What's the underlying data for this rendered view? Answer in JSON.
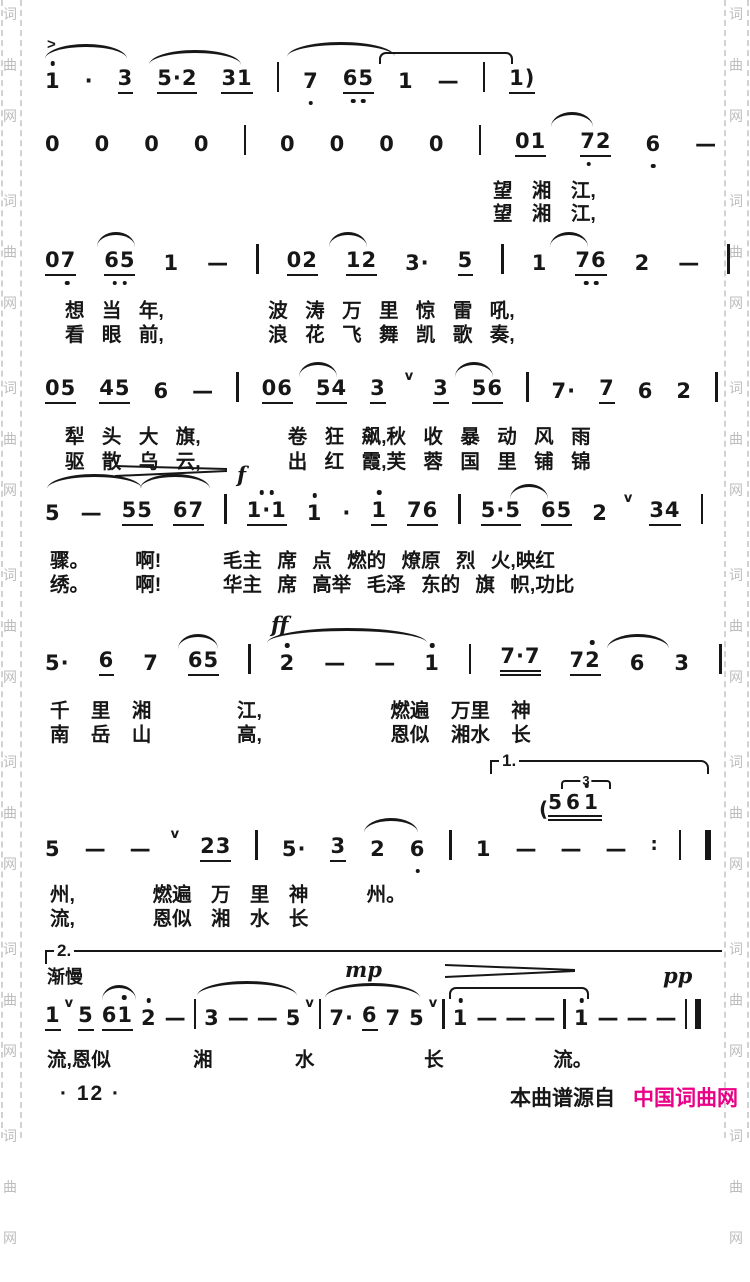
{
  "colors": {
    "ink": "#171717",
    "site_magenta": "#ea0087",
    "watermark_gray": "#bdbdbd"
  },
  "watermark": {
    "column": [
      "词",
      "曲",
      "网",
      "词",
      "曲",
      "网",
      "词",
      "曲",
      "网",
      "词",
      "曲",
      "网",
      "词",
      "曲",
      "网",
      "词",
      "曲",
      "网",
      "词",
      "曲",
      "网"
    ]
  },
  "page": {
    "number": "· 12 ·",
    "source_prefix": "本曲谱源自",
    "source_site": "中国词曲网"
  },
  "systems": [
    {
      "accent_mark": ">",
      "tokens": [
        {
          "t": "1",
          "c": "hd"
        },
        {
          "t": "·",
          "c": "aug"
        },
        {
          "t": "3",
          "c": "u1"
        },
        {
          "t": "5·2",
          "c": "u1"
        },
        {
          "t": "31",
          "c": "u1"
        },
        {
          "c": "bar"
        },
        {
          "t": "7",
          "c": "ld"
        },
        {
          "t": "65",
          "c": "u1 ld2"
        },
        {
          "t": "1"
        },
        {
          "t": "—",
          "c": "dash"
        },
        {
          "c": "bar"
        },
        {
          "t": "1)",
          "c": "u1"
        }
      ],
      "lyrics": []
    },
    {
      "tokens": [
        {
          "t": "0"
        },
        {
          "t": "0"
        },
        {
          "t": "0"
        },
        {
          "t": "0"
        },
        {
          "c": "bar"
        },
        {
          "t": "0"
        },
        {
          "t": "0"
        },
        {
          "t": "0"
        },
        {
          "t": "0"
        },
        {
          "c": "bar"
        },
        {
          "t": "01",
          "c": "u1"
        },
        {
          "t": "72",
          "c": "u1 ldl"
        },
        {
          "t": "6",
          "c": "ld"
        },
        {
          "t": "—",
          "c": "dash"
        },
        {
          "c": "bar"
        }
      ],
      "lyrics": [
        "望 湘 江,",
        "望 湘 江,"
      ]
    },
    {
      "tokens": [
        {
          "t": "07",
          "c": "u1 ldr"
        },
        {
          "t": "65",
          "c": "u1 ld2"
        },
        {
          "t": "1"
        },
        {
          "t": "—",
          "c": "dash"
        },
        {
          "c": "bar"
        },
        {
          "t": "02",
          "c": "u1"
        },
        {
          "t": "12",
          "c": "u1"
        },
        {
          "t": "3·"
        },
        {
          "t": "5",
          "c": "u1"
        },
        {
          "c": "bar"
        },
        {
          "t": "1"
        },
        {
          "t": "76",
          "c": "u1 ld2"
        },
        {
          "t": "2"
        },
        {
          "t": "—",
          "c": "dash"
        },
        {
          "c": "bar"
        }
      ],
      "lyrics": [
        "想 当 年,      波 涛 万 里 惊 雷 吼,",
        "看 眼 前,      浪 花 飞 舞 凯 歌 奏,"
      ]
    },
    {
      "tokens": [
        {
          "t": "05",
          "c": "u1"
        },
        {
          "t": "45",
          "c": "u1"
        },
        {
          "t": "6"
        },
        {
          "t": "—",
          "c": "dash"
        },
        {
          "c": "bar"
        },
        {
          "t": "06",
          "c": "u1"
        },
        {
          "t": "54",
          "c": "u1"
        },
        {
          "t": "3",
          "c": "u1"
        },
        {
          "t": "v",
          "c": "breath"
        },
        {
          "t": "3",
          "c": "u1"
        },
        {
          "t": "56",
          "c": "u1"
        },
        {
          "c": "bar"
        },
        {
          "t": "7·"
        },
        {
          "t": "7",
          "c": "u1"
        },
        {
          "t": "6"
        },
        {
          "t": "2"
        },
        {
          "c": "bar"
        }
      ],
      "lyrics": [
        "犁 头 大 旗,     卷 狂 飙,秋 收 暴 动 风 雨",
        "驱 散 乌 云,     出 红 霞,芙 蓉 国 里 铺 锦"
      ]
    },
    {
      "dynamic": "f",
      "tokens": [
        {
          "t": "5"
        },
        {
          "t": "—",
          "c": "dash"
        },
        {
          "t": "55",
          "c": "u1"
        },
        {
          "t": "67",
          "c": "u1"
        },
        {
          "c": "bar"
        },
        {
          "t": "1·1",
          "c": "u1 hd2"
        },
        {
          "t": "1",
          "c": "hd"
        },
        {
          "t": "·",
          "c": "aug"
        },
        {
          "t": "1",
          "c": "hd u1"
        },
        {
          "t": "76",
          "c": "u1"
        },
        {
          "c": "bar"
        },
        {
          "t": "5·5",
          "c": "u1"
        },
        {
          "t": "65",
          "c": "u1"
        },
        {
          "t": "2"
        },
        {
          "t": "v",
          "c": "breath"
        },
        {
          "t": "34",
          "c": "u1"
        },
        {
          "c": "bar"
        }
      ],
      "lyrics": [
        "骤。   啊!    毛主 席 点 燃的 燎原 烈 火,映红",
        "绣。   啊!    华主 席 高举 毛泽 东的 旗 帜,功比"
      ]
    },
    {
      "dynamic": "ff",
      "tokens": [
        {
          "t": "5·"
        },
        {
          "t": "6",
          "c": "u1"
        },
        {
          "t": "7"
        },
        {
          "t": "65",
          "c": "u1"
        },
        {
          "c": "bar"
        },
        {
          "t": "2",
          "c": "hd"
        },
        {
          "t": "—",
          "c": "dash"
        },
        {
          "t": "—",
          "c": "dash"
        },
        {
          "t": "1",
          "c": "hd"
        },
        {
          "c": "bar"
        },
        {
          "t": "7·7",
          "c": "u2"
        },
        {
          "t": "72",
          "c": "u1 hdr"
        },
        {
          "t": "6"
        },
        {
          "t": "3"
        },
        {
          "c": "bar"
        }
      ],
      "lyrics": [
        "千 里 湘    江,      燃遍 万里 神",
        "南 岳 山    高,      恩似 湘水 长"
      ]
    },
    {
      "volta": "1.",
      "tuplet": "3",
      "cue_paren": "(",
      "cue_notes": "561",
      "tokens": [
        {
          "t": "5"
        },
        {
          "t": "—",
          "c": "dash"
        },
        {
          "t": "—",
          "c": "dash"
        },
        {
          "t": "v",
          "c": "breath"
        },
        {
          "t": "23",
          "c": "u1"
        },
        {
          "c": "bar"
        },
        {
          "t": "5·"
        },
        {
          "t": "3",
          "c": "u1"
        },
        {
          "t": "2"
        },
        {
          "t": "6",
          "c": "ld"
        },
        {
          "c": "bar"
        },
        {
          "t": "1"
        },
        {
          "t": "—",
          "c": "dash"
        },
        {
          "t": "—",
          "c": "dash"
        },
        {
          "t": "—",
          "c": "dash"
        },
        {
          "t": ":",
          "c": "rptc"
        },
        {
          "c": "bar"
        },
        {
          "c": "bar thick"
        }
      ],
      "lyrics": [
        "州,    燃遍 万 里 神   州。",
        "流,    恩似 湘 水 长"
      ]
    },
    {
      "volta": "2.",
      "tempo": "渐慢",
      "dynamic_mp": "mp",
      "dynamic_pp": "pp",
      "tokens": [
        {
          "t": "1",
          "c": "u1"
        },
        {
          "t": "v",
          "c": "breath"
        },
        {
          "t": "5",
          "c": "u1"
        },
        {
          "t": "61",
          "c": "u1 hdr"
        },
        {
          "t": "2",
          "c": "hd"
        },
        {
          "t": "—",
          "c": "dash"
        },
        {
          "c": "bar"
        },
        {
          "t": "3"
        },
        {
          "t": "—",
          "c": "dash"
        },
        {
          "t": "—",
          "c": "dash"
        },
        {
          "t": "5"
        },
        {
          "t": "v",
          "c": "breath"
        },
        {
          "c": "bar"
        },
        {
          "t": "7·"
        },
        {
          "t": "6",
          "c": "u1"
        },
        {
          "t": "7"
        },
        {
          "t": "5"
        },
        {
          "t": "v",
          "c": "breath"
        },
        {
          "c": "bar"
        },
        {
          "t": "1",
          "c": "hd"
        },
        {
          "t": "—",
          "c": "dash"
        },
        {
          "t": "—",
          "c": "dash"
        },
        {
          "t": "—",
          "c": "dash"
        },
        {
          "c": "bar"
        },
        {
          "t": "1",
          "c": "hd"
        },
        {
          "t": "—",
          "c": "dash"
        },
        {
          "t": "—",
          "c": "dash"
        },
        {
          "t": "—",
          "c": "dash"
        },
        {
          "c": "bar"
        },
        {
          "c": "bar thick"
        }
      ],
      "lyrics": [
        "流,恩似   湘   水    长    流。"
      ]
    }
  ]
}
